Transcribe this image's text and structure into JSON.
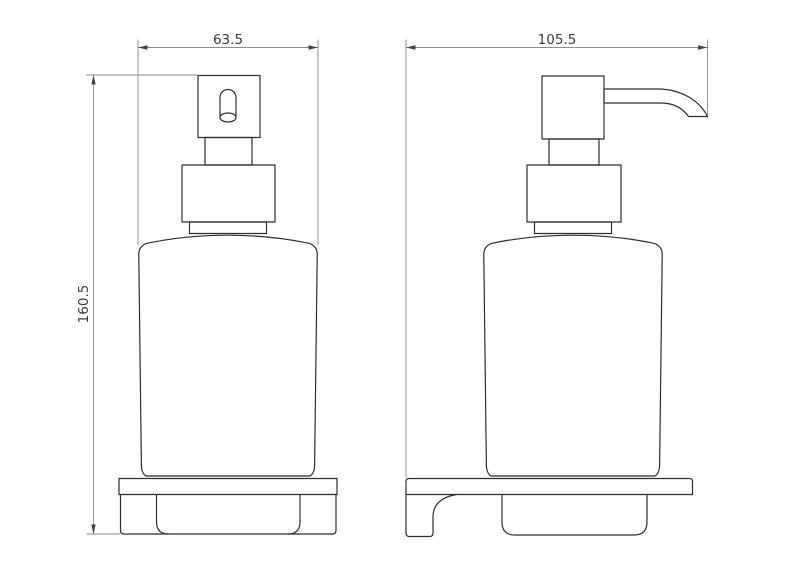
{
  "drawing": {
    "background": "#ffffff",
    "colors": {
      "object_line": "#2e2e2e",
      "dimension_line": "#8c8c8c",
      "arrow": "#444444",
      "text": "#3a3a3a"
    },
    "views": {
      "front": {
        "name": "front-view",
        "width": {
          "value": "63.5"
        },
        "height": {
          "value": "160.5"
        }
      },
      "side": {
        "name": "side-view",
        "width": {
          "value": "105.5"
        }
      }
    }
  }
}
